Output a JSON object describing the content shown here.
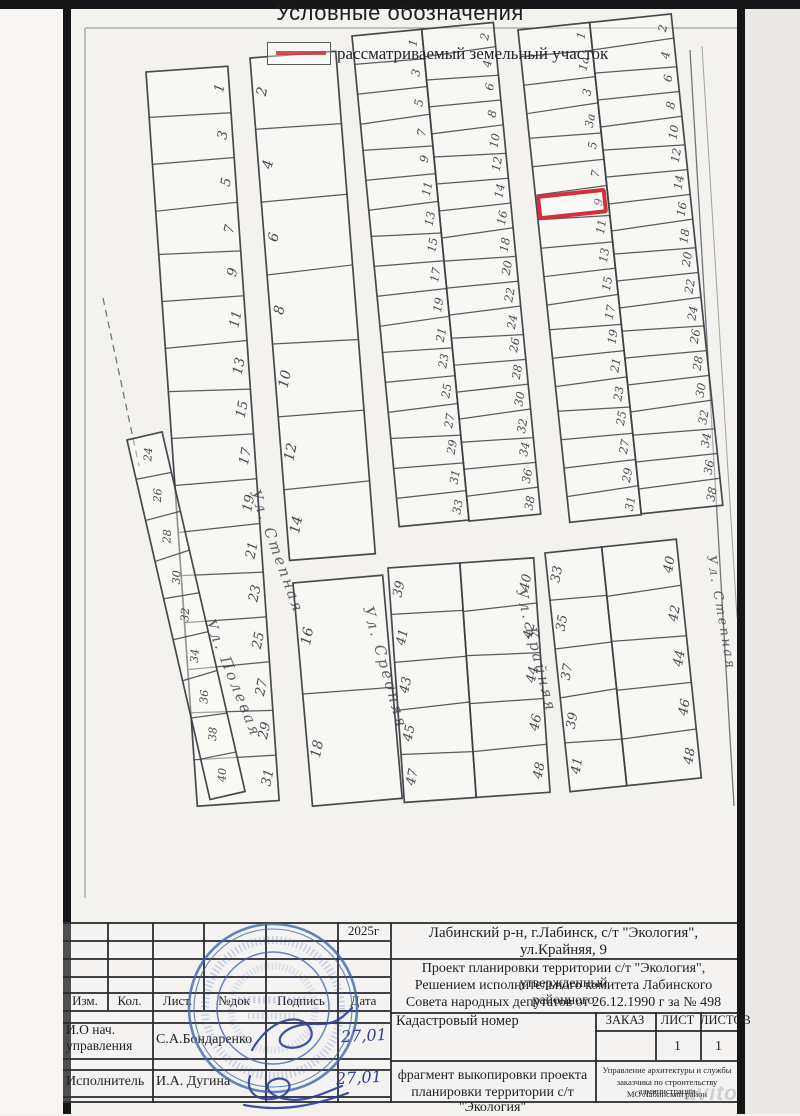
{
  "map": {
    "strips": [
      {
        "id": "s1",
        "cols": [
          [
            "1",
            "3",
            "5",
            "7",
            "9",
            "11",
            "13",
            "15",
            "17",
            "19",
            "21",
            "23",
            "25",
            "27",
            "29",
            "31"
          ]
        ]
      },
      {
        "id": "s2",
        "cols": [
          [
            "2",
            "4",
            "6",
            "8",
            "10",
            "12",
            "14"
          ]
        ]
      },
      {
        "id": "s3",
        "cols": [
          [
            "1",
            "3",
            "5",
            "7",
            "9",
            "11",
            "13",
            "15",
            "17",
            "19",
            "21",
            "23",
            "25",
            "27",
            "29",
            "31",
            "33"
          ],
          [
            "2",
            "4",
            "6",
            "8",
            "10",
            "12",
            "14",
            "16",
            "18",
            "20",
            "22",
            "24",
            "26",
            "28",
            "30",
            "32",
            "34",
            "36",
            "38"
          ]
        ]
      },
      {
        "id": "s4",
        "cols": [
          [
            "1",
            "1а",
            "3",
            "3а",
            "5",
            "7",
            "9",
            "11",
            "13",
            "15",
            "17",
            "19",
            "21",
            "23",
            "25",
            "27",
            "29",
            "31"
          ],
          [
            "2",
            "4",
            "6",
            "8",
            "10",
            "12",
            "14",
            "16",
            "18",
            "20",
            "22",
            "24",
            "26",
            "28",
            "30",
            "32",
            "34",
            "36",
            "38"
          ]
        ],
        "highlight": {
          "col": 0,
          "row": 6,
          "plot": "9"
        }
      },
      {
        "id": "b1",
        "cols": [
          [
            "24",
            "26",
            "28",
            "30",
            "32",
            "34",
            "36",
            "38",
            "40"
          ]
        ]
      },
      {
        "id": "b2",
        "cols": [
          [
            "16",
            "18"
          ]
        ]
      },
      {
        "id": "b3",
        "cols": [
          [
            "39",
            "41",
            "43",
            "45",
            "47"
          ],
          [
            "40",
            "42",
            "44",
            "46",
            "48"
          ]
        ]
      },
      {
        "id": "b4",
        "cols": [
          [
            "33",
            "35",
            "37",
            "39",
            "41"
          ],
          [
            "40",
            "42",
            "44",
            "46",
            "48"
          ]
        ]
      }
    ],
    "streets": [
      {
        "name": "Ул. Степная"
      },
      {
        "name": "Ул. Полевая"
      },
      {
        "name": "Ул. Средняя"
      },
      {
        "name": "Ул. Крайняя"
      },
      {
        "name": "Ул. Степная"
      }
    ],
    "highlighted_plot": "9"
  },
  "legend": {
    "title": "Условные обозначения",
    "items": [
      {
        "swatch_color": "#cf3038",
        "label": "рассматриваемый земельный участок"
      }
    ]
  },
  "title_block": {
    "year": "2025г",
    "address_line1": "Лабинский р-н, г.Лабинск, с/т \"Экология\",",
    "address_line2": "ул.Крайняя, 9",
    "project_line1": "Проект планировки  территории с/т \"Экология\", утвержденный",
    "project_line2": "Решением исполнительного комитета Лабинского районного",
    "project_line3": "Совета народных депутатов от 26.12.1990 г за № 498",
    "col_izm": "Изм.",
    "col_kol": "Кол.",
    "col_list": "Лист.",
    "col_ndok": "№док",
    "col_podpis": "Подпись",
    "col_data": "Дата",
    "cadastral_label": "Кадастровый номер",
    "order_label": "ЗАКАЗ",
    "sheet_label": "ЛИСТ",
    "sheets_label": "ЛИСТОВ",
    "sheet_value": "1",
    "sheets_value": "1",
    "role1_line1": "И.О нач.",
    "role1_line2": "управления",
    "name1": "С.А.Бондаренко",
    "date1": "27,01",
    "role2": "Исполнитель",
    "name2": "И.А. Дугина",
    "date2": "27,01",
    "doc_title_line1": "фрагмент выкопировки проекта",
    "doc_title_line2": "планировки  территории с/т \"Экология\"",
    "org_line1": "Управление архитектуры и службы",
    "org_line2": "заказчика по строительству администрации",
    "org_line3": "МО Лабинский район"
  },
  "watermark": "avito"
}
